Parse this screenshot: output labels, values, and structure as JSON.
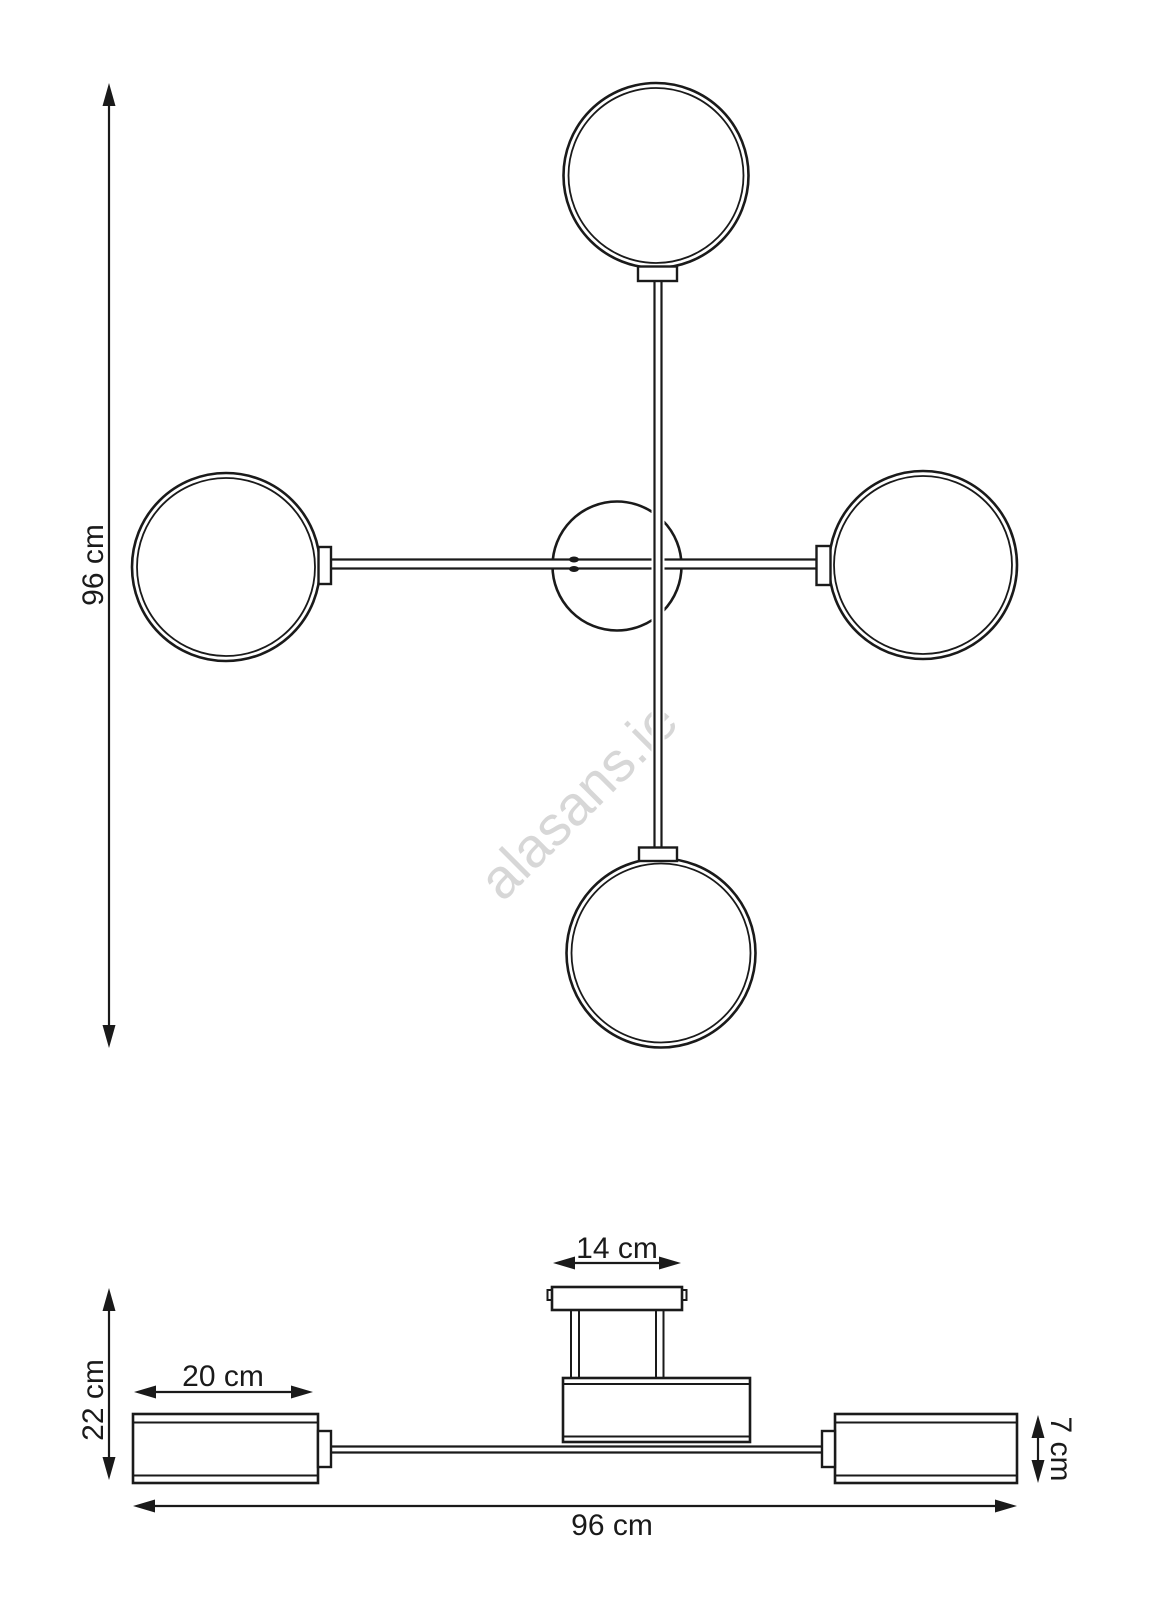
{
  "drawing": {
    "background_color": "#ffffff",
    "line_color": "#1a1a1a",
    "watermark": {
      "text": "alasans.ie",
      "color": "#d7d7d7"
    },
    "top_view": {
      "height_label": "96 cm"
    },
    "side_view": {
      "height_label": "22 cm",
      "shade_width_label": "20 cm",
      "canopy_width_label": "14 cm",
      "shade_height_label": "7 cm",
      "width_label": "96 cm"
    }
  }
}
